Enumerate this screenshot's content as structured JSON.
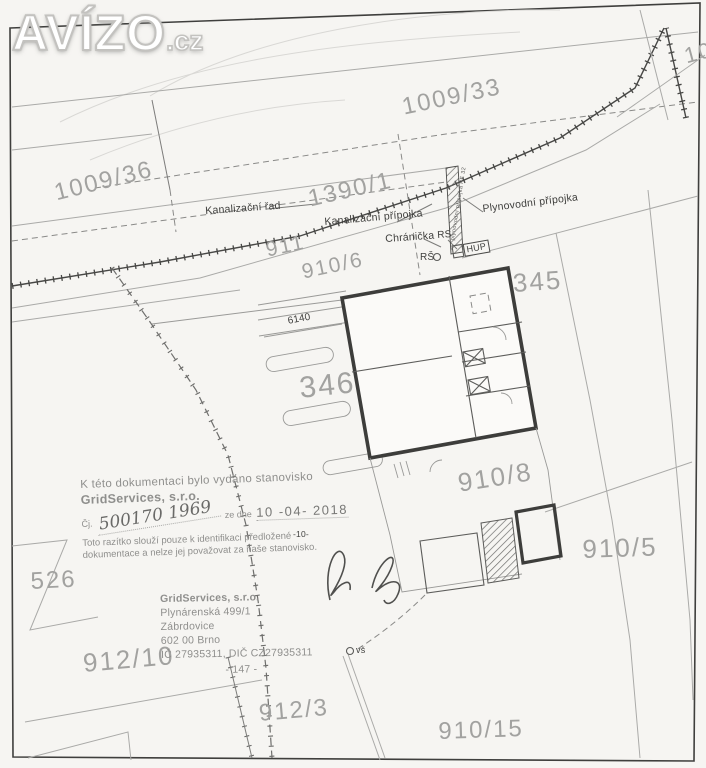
{
  "watermark": {
    "brand": "AVÍZO",
    "tld": ".cz"
  },
  "parcels": {
    "p1009_33": "1009/33",
    "p10_partial": "10",
    "p1009_36": "1009/36",
    "p1390_1": "1390/1",
    "p911": "911",
    "p910_6": "910/6",
    "p345": "345",
    "p346": "346",
    "p910_8": "910/8",
    "p910_5": "910/5",
    "p526": "526",
    "p912_10": "912/10",
    "p912_3": "912/3",
    "p910_15": "910/15"
  },
  "utilities": {
    "kanalizacni_rad": "Kanalizační řad",
    "kanalizacni_pripojka": "Kanalizační přípojka",
    "plynovodni_pripojka": "Plynovodní přípojka",
    "chranicka": "Chránička",
    "rs": "RS",
    "rs_shaft": "RŠ",
    "hup": "HUP",
    "vs": "vš",
    "pipe_note": "plynovodní přípojka PE 32",
    "dim_6140": "6140",
    "mark_10": "-10-"
  },
  "stamp": {
    "line1": "K této dokumentaci bylo vydáno stanovisko",
    "company": "GridServices, s.r.o.",
    "cj_label": "Čj.",
    "cj_number": "500170 1969",
    "ze_dne": "ze dne",
    "date": "10 -04- 2018",
    "disclaimer1": "Toto razítko slouží pouze k identifikaci předložené",
    "disclaimer2": "dokumentace a nelze jej považovat za naše stanovisko."
  },
  "address": {
    "company": "GridServices, s.r.o.",
    "street": "Plynárenská 499/1",
    "district": "Zábrdovice",
    "city": "602 00 Brno",
    "ids": "IČ 27935311, DIČ CZ27935311",
    "code": "- 147 -"
  },
  "colors": {
    "paper": "#f6f5f2",
    "line_light": "#aaaaa8",
    "line_dark": "#474745",
    "parcel_text": "#a2a2a0",
    "stamp_gray": "#8f8f8d"
  }
}
